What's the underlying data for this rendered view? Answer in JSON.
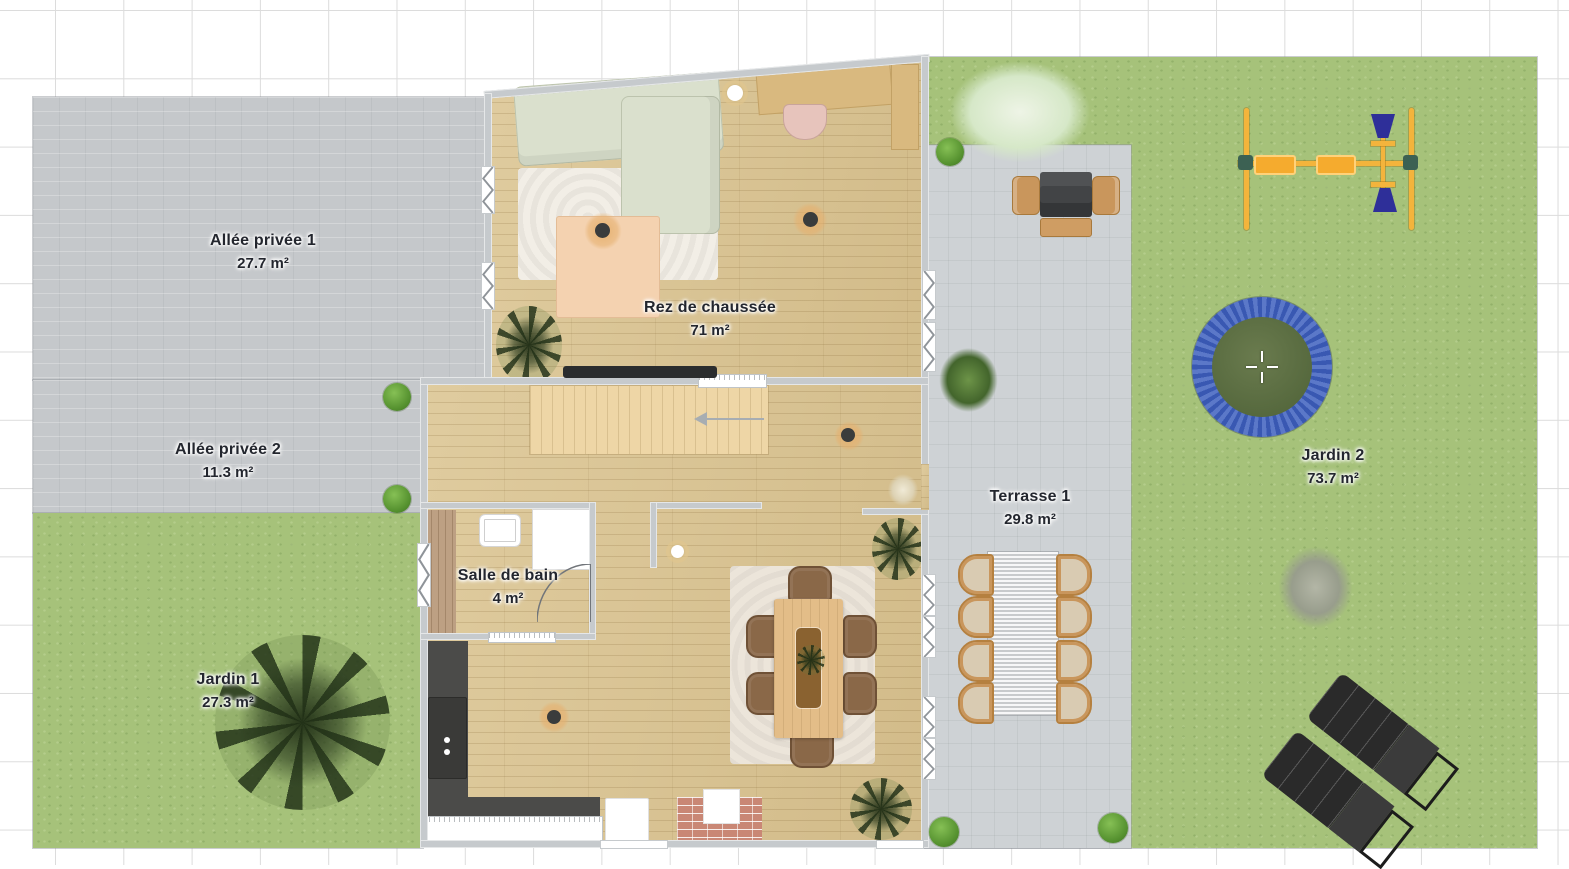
{
  "zones": [
    {
      "name": "Allée privée 1",
      "area": "27.7 m²"
    },
    {
      "name": "Allée privée 2",
      "area": "11.3 m²"
    },
    {
      "name": "Jardin 1",
      "area": "27.3 m²"
    },
    {
      "name": "Rez de chaussée",
      "area": "71 m²"
    },
    {
      "name": "Salle de bain",
      "area": "4 m²"
    },
    {
      "name": "Terrasse 1",
      "area": "29.8 m²"
    },
    {
      "name": "Jardin 2",
      "area": "73.7 m²"
    }
  ],
  "colors": {
    "grass": "#a6c27a",
    "paving": "#c5c8cb",
    "terrace": "#ced2d5",
    "wood_floor": "#dcc694",
    "wall": "#c6cacd",
    "trampoline_ring": "#3e60bf",
    "trampoline_mat": "#64754a",
    "swing_frame": "#f3b43c",
    "glider_seat": "#2e2f99",
    "lounger": "#2a2a2a",
    "kitchen_counter": "#4b4b49",
    "label_text": "#23262e"
  }
}
